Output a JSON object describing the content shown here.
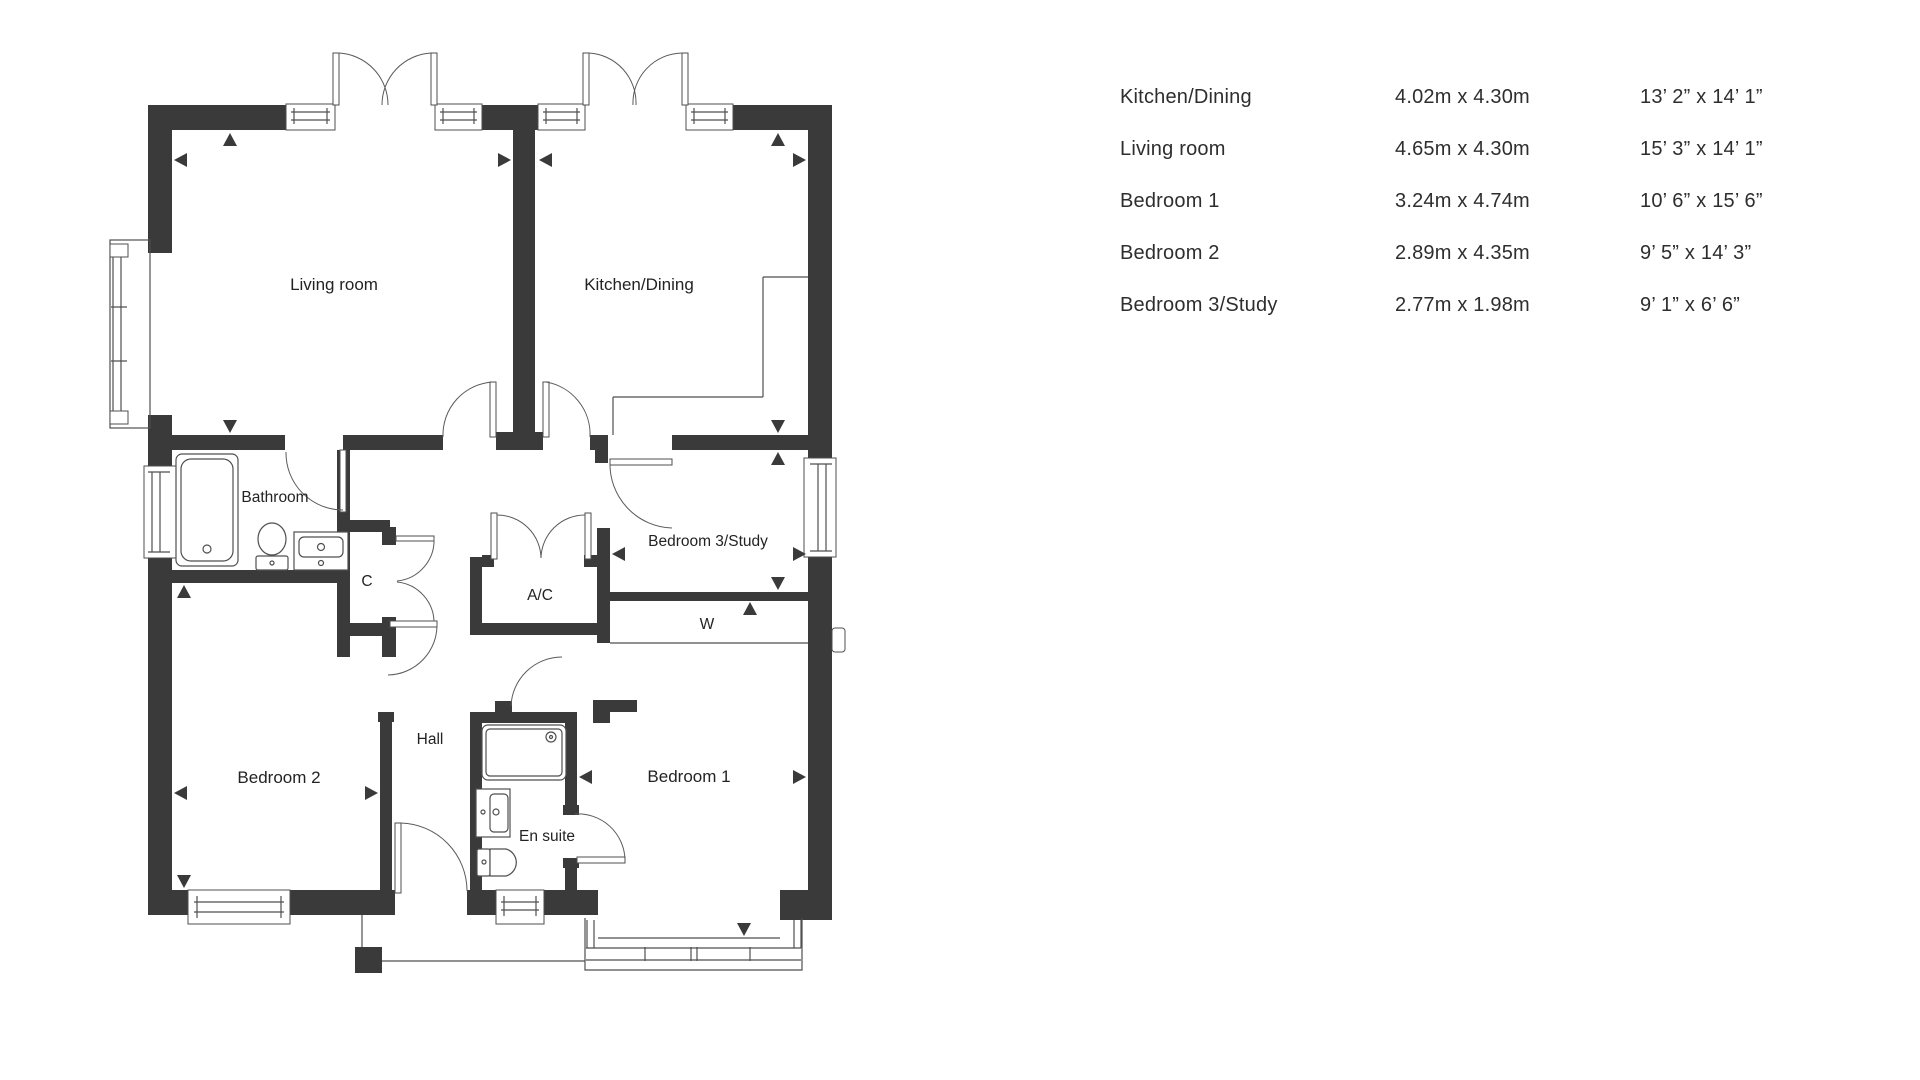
{
  "table": {
    "rows": [
      {
        "name": "Kitchen/Dining",
        "metric": "4.02m x 4.30m",
        "imperial": "13’ 2” x 14’ 1”"
      },
      {
        "name": "Living room",
        "metric": "4.65m x 4.30m",
        "imperial": "15’ 3” x 14’ 1”"
      },
      {
        "name": "Bedroom 1",
        "metric": "3.24m x 4.74m",
        "imperial": "10’ 6” x 15’ 6”"
      },
      {
        "name": "Bedroom 2",
        "metric": "2.89m x 4.35m",
        "imperial": "9’ 5” x 14’ 3”"
      },
      {
        "name": "Bedroom 3/Study",
        "metric": "2.77m x 1.98m",
        "imperial": "9’ 1” x 6’ 6”"
      }
    ]
  },
  "plan": {
    "labels": {
      "living": "Living room",
      "kitchen": "Kitchen/Dining",
      "bathroom": "Bathroom",
      "c": "C",
      "ac": "A/C",
      "bed3": "Bedroom 3/Study",
      "w": "W",
      "hall": "Hall",
      "bed2": "Bedroom 2",
      "ensuite": "En suite",
      "bed1": "Bedroom 1"
    }
  },
  "colors": {
    "wall": "#3a3a3a",
    "line": "#4f4f4f",
    "text": "#2e2e2e",
    "background": "#ffffff"
  }
}
